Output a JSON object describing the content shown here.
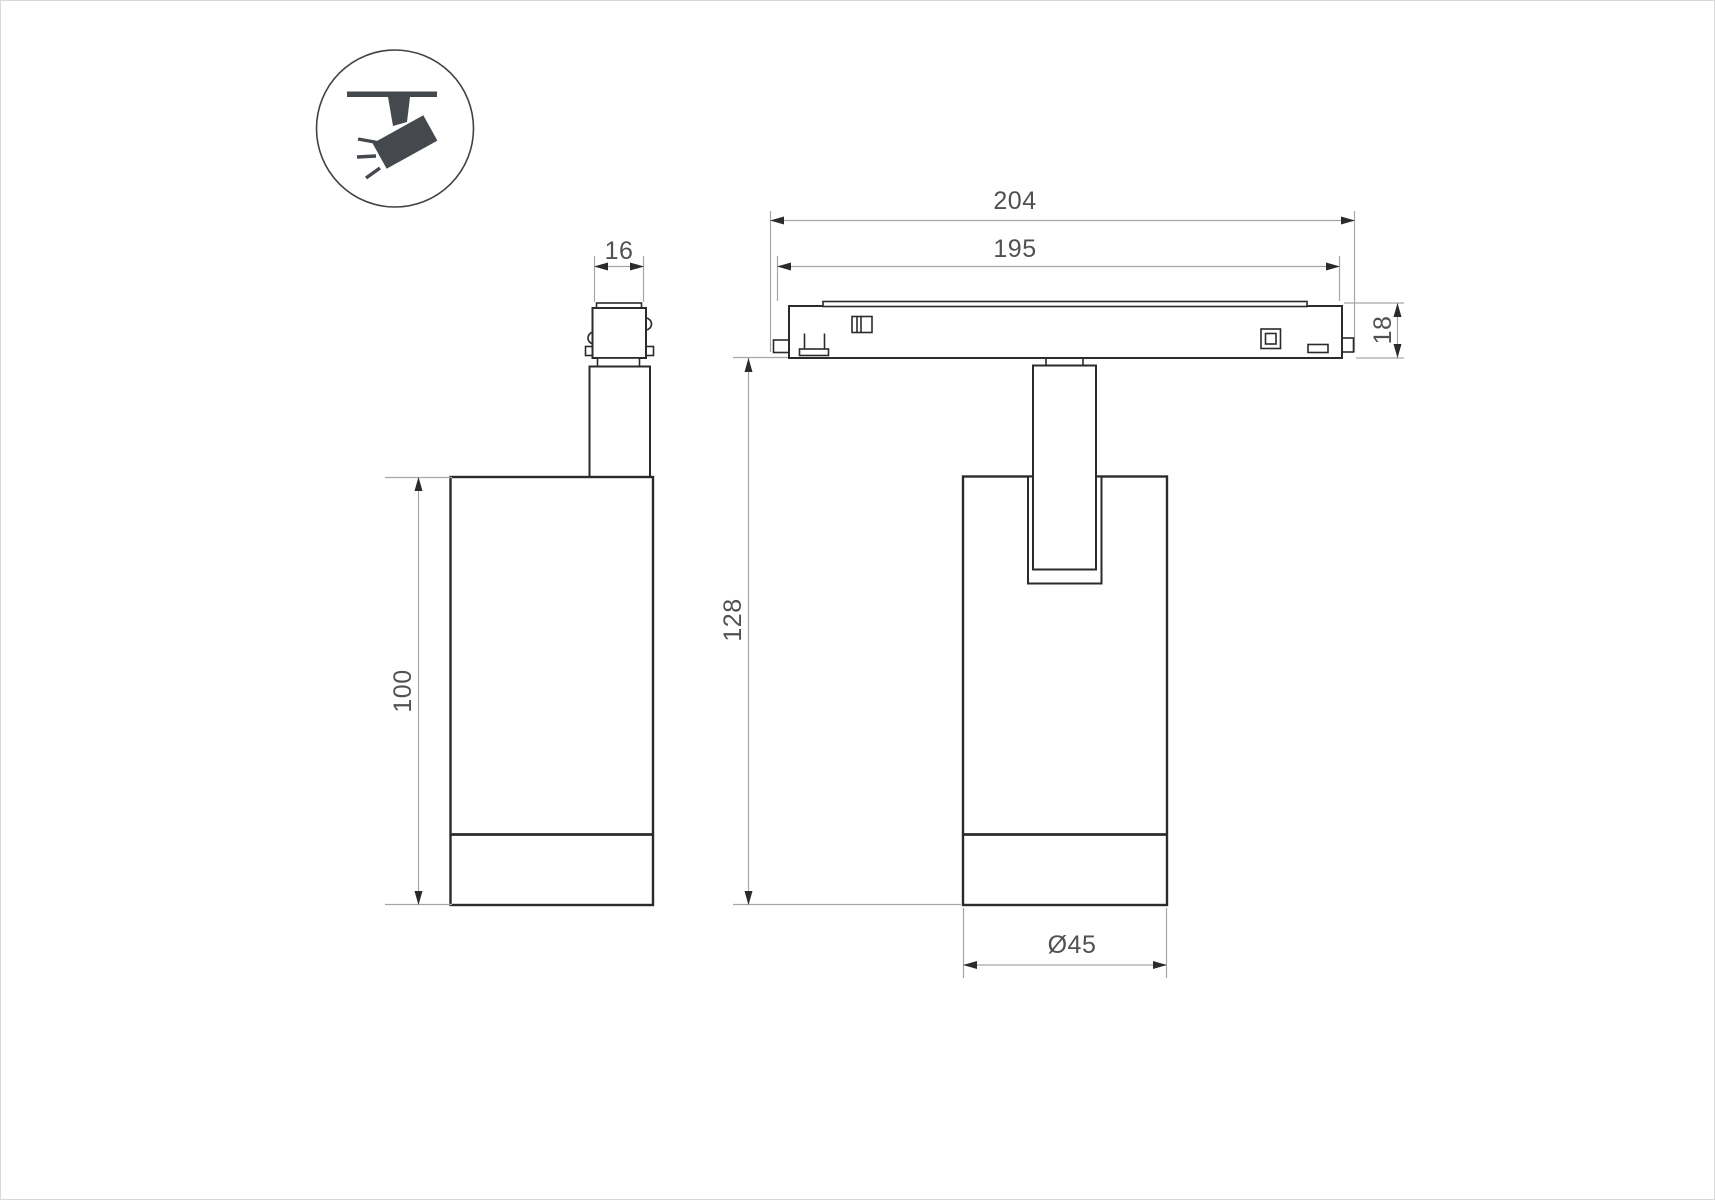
{
  "icon": {
    "name": "ceiling-track-spotlight",
    "color": "#45494d"
  },
  "colors": {
    "background": "#ffffff",
    "object_line": "#2b2b2d",
    "dimension_line": "#a6a6a6",
    "dimension_text": "#515151"
  },
  "dimensions": {
    "adapter_width": "16",
    "body_height": "100",
    "track_total_length": "204",
    "track_inner_length": "195",
    "track_height": "18",
    "hanging_height": "128",
    "body_diameter": "Ø45"
  }
}
